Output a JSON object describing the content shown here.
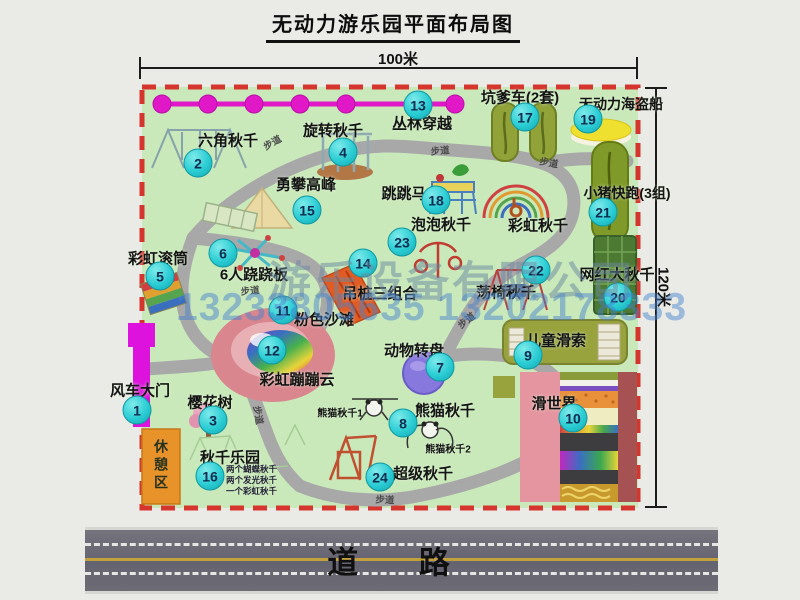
{
  "title": "无动力游乐园平面布局图",
  "scale": {
    "width_label": "100米",
    "height_label": "120米"
  },
  "road": {
    "label": "道 路"
  },
  "watermark": {
    "company": "游乐设备有限公司",
    "phone": "13233805635 13202178333"
  },
  "rest_area_label": "休憩区",
  "walkway": "步道",
  "attractions": [
    {
      "num": "1",
      "label": "风车大门"
    },
    {
      "num": "2",
      "label": "六角秋千"
    },
    {
      "num": "3",
      "label": "樱花树"
    },
    {
      "num": "4",
      "label": "旋转秋千"
    },
    {
      "num": "5",
      "label": "彩虹滚筒"
    },
    {
      "num": "6",
      "label": "6人跷跷板"
    },
    {
      "num": "7",
      "label": "动物转盘"
    },
    {
      "num": "8",
      "label": "熊猫秋千"
    },
    {
      "num": "9",
      "label": "儿童滑索"
    },
    {
      "num": "10",
      "label": "滑世界"
    },
    {
      "num": "11",
      "label": "粉色沙滩"
    },
    {
      "num": "12",
      "label": "彩虹蹦蹦云"
    },
    {
      "num": "13",
      "label": "丛林穿越"
    },
    {
      "num": "14",
      "label": "吊桩三组合"
    },
    {
      "num": "15",
      "label": "勇攀高峰"
    },
    {
      "num": "16",
      "label": "秋千乐园"
    },
    {
      "num": "17",
      "label": "坑爹车(2套)"
    },
    {
      "num": "18",
      "label": "跳跳马"
    },
    {
      "num": "19",
      "label": "无动力海盗船"
    },
    {
      "num": "20",
      "label": "网红大秋千"
    },
    {
      "num": "21",
      "label": "小猪快跑(3组)"
    },
    {
      "num": "22",
      "label": "荡椅秋千"
    },
    {
      "num": "23",
      "label": "泡泡秋千"
    },
    {
      "num": "24",
      "label": "超级秋千"
    },
    {
      "num": "",
      "label": "彩虹秋千"
    }
  ],
  "panda_sub": [
    "熊猫秋千1",
    "熊猫秋千2"
  ],
  "swing_park_notes": [
    "两个蝴蝶秋千",
    "两个发光秋千",
    "一个彩虹秋千"
  ],
  "colors": {
    "lawn": "#c9e9ba",
    "border_dash": "#d5352c",
    "path_gray": "#a8a8a8",
    "badge_cyan": "#2bcdd4",
    "gate_magenta": "#dd12dd",
    "chain_magenta": "#e018c8",
    "rest_area_orange": "#e8922a",
    "road_gray": "#6d6c75",
    "road_line_yellow": "#c2a03c"
  }
}
